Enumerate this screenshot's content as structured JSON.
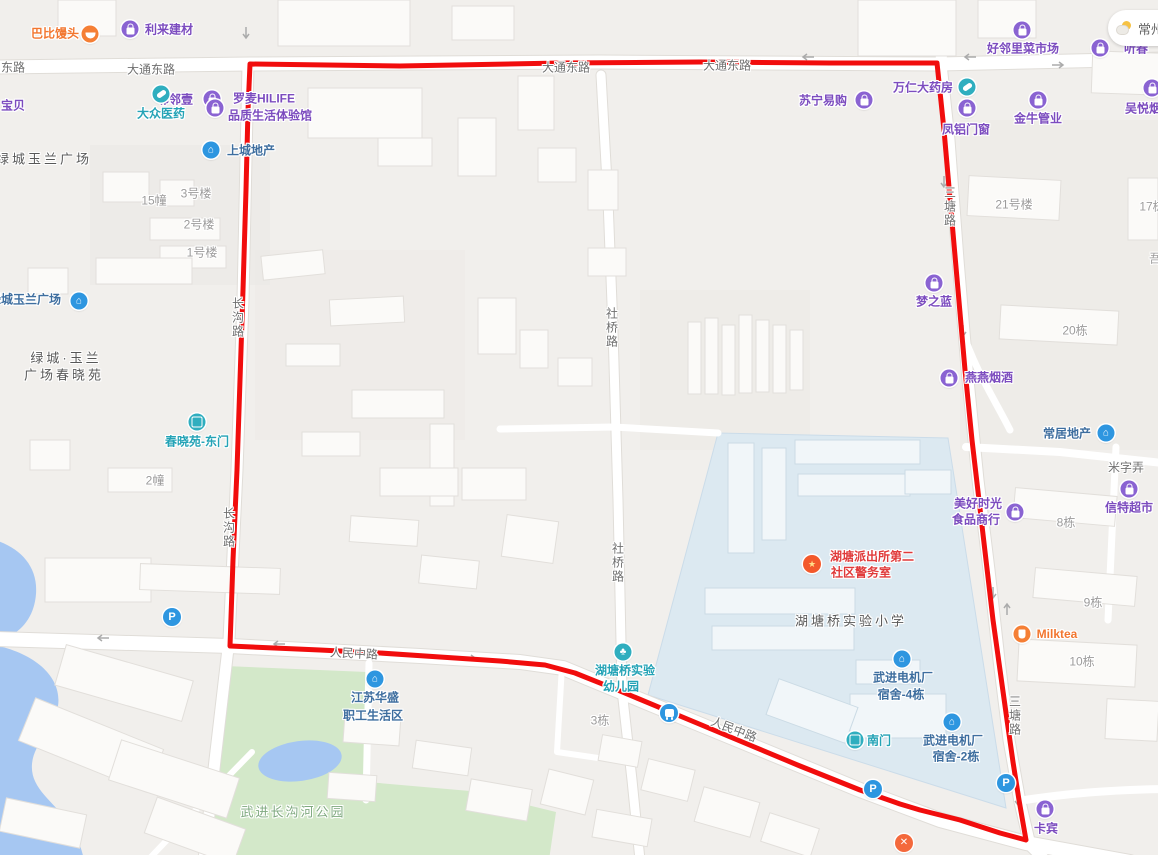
{
  "weather": {
    "city": "常州"
  },
  "colors": {
    "overlay_red": "#F10D0D",
    "land": "#F1EFEC",
    "water": "#A6C7F2",
    "park": "#D3E8C9",
    "campus": "#DCE9F1",
    "road": "#FFFFFF",
    "poi_purple": "#7C4CBF",
    "poi_teal": "#24A3B6",
    "poi_orange": "#F2762F",
    "poi_red": "#E03A3A",
    "poi_residential_blue": "#3E6E9F"
  },
  "overlay": {
    "color": "#F10D0D",
    "width": 5,
    "points": [
      [
        250,
        64
      ],
      [
        400,
        66
      ],
      [
        560,
        63
      ],
      [
        700,
        62
      ],
      [
        830,
        63
      ],
      [
        937,
        63
      ],
      [
        944,
        130
      ],
      [
        951,
        210
      ],
      [
        958,
        290
      ],
      [
        965,
        370
      ],
      [
        972,
        440
      ],
      [
        979,
        500
      ],
      [
        986,
        560
      ],
      [
        993,
        620
      ],
      [
        1000,
        670
      ],
      [
        1007,
        720
      ],
      [
        1013,
        762
      ],
      [
        1019,
        800
      ],
      [
        1026,
        840
      ],
      [
        1000,
        833
      ],
      [
        960,
        820
      ],
      [
        920,
        810
      ],
      [
        900,
        804
      ],
      [
        860,
        790
      ],
      [
        800,
        766
      ],
      [
        740,
        741
      ],
      [
        680,
        716
      ],
      [
        620,
        691
      ],
      [
        575,
        673
      ],
      [
        545,
        665
      ],
      [
        500,
        661
      ],
      [
        440,
        657
      ],
      [
        380,
        653
      ],
      [
        320,
        650
      ],
      [
        230,
        646
      ],
      [
        233,
        560
      ],
      [
        237,
        470
      ],
      [
        240,
        380
      ],
      [
        243,
        290
      ],
      [
        246,
        190
      ],
      [
        248,
        110
      ],
      [
        250,
        64
      ]
    ]
  },
  "labels": [
    {
      "id": "road-donglu",
      "t": "东路",
      "x": 13,
      "y": 67,
      "c": "road"
    },
    {
      "id": "road-datong-1",
      "t": "大通东路",
      "x": 151,
      "y": 69,
      "c": "road"
    },
    {
      "id": "road-datong-2",
      "t": "大通东路",
      "x": 566,
      "y": 67,
      "c": "road"
    },
    {
      "id": "road-datong-3",
      "t": "大通东路",
      "x": 727,
      "y": 65,
      "c": "road"
    },
    {
      "id": "road-changgou-1",
      "t": "长沟路",
      "x": 238,
      "y": 318,
      "c": "road",
      "v": true
    },
    {
      "id": "road-changgou-2",
      "t": "长沟路",
      "x": 229,
      "y": 528,
      "c": "road",
      "v": true
    },
    {
      "id": "road-sheqiao-1",
      "t": "社桥路",
      "x": 612,
      "y": 328,
      "c": "road",
      "v": true
    },
    {
      "id": "road-sheqiao-2",
      "t": "社桥路",
      "x": 618,
      "y": 563,
      "c": "road",
      "v": true
    },
    {
      "id": "road-santang-1",
      "t": "三塘路",
      "x": 950,
      "y": 207,
      "c": "road",
      "v": true
    },
    {
      "id": "road-santang-2",
      "t": "三塘路",
      "x": 1015,
      "y": 716,
      "c": "road",
      "v": true
    },
    {
      "id": "road-renmin-1",
      "t": "人民中路",
      "x": 354,
      "y": 653,
      "c": "road",
      "r": 3
    },
    {
      "id": "road-renmin-2",
      "t": "人民中路",
      "x": 734,
      "y": 729,
      "c": "road",
      "r": 21
    },
    {
      "id": "road-mizi",
      "t": "米字弄",
      "x": 1126,
      "y": 467,
      "c": "road"
    },
    {
      "id": "bldg-3haolou",
      "t": "3号楼",
      "x": 196,
      "y": 193,
      "c": "dim"
    },
    {
      "id": "bldg-15zhuang",
      "t": "15幢",
      "x": 154,
      "y": 200,
      "c": "dim"
    },
    {
      "id": "bldg-2haolou",
      "t": "2号楼",
      "x": 199,
      "y": 224,
      "c": "dim"
    },
    {
      "id": "bldg-1haolou",
      "t": "1号楼",
      "x": 202,
      "y": 252,
      "c": "dim"
    },
    {
      "id": "bldg-2zhuang",
      "t": "2幢",
      "x": 155,
      "y": 480,
      "c": "dim"
    },
    {
      "id": "bldg-3dong",
      "t": "3栋",
      "x": 600,
      "y": 720,
      "c": "dim"
    },
    {
      "id": "bldg-21haolou",
      "t": "21号楼",
      "x": 1014,
      "y": 204,
      "c": "dim"
    },
    {
      "id": "bldg-17dong",
      "t": "17栋",
      "x": 1152,
      "y": 206,
      "c": "dim"
    },
    {
      "id": "bldg-wu",
      "t": "吾",
      "x": 1155,
      "y": 258,
      "c": "dim"
    },
    {
      "id": "bldg-20dong",
      "t": "20栋",
      "x": 1075,
      "y": 330,
      "c": "dim"
    },
    {
      "id": "bldg-8dong",
      "t": "8栋",
      "x": 1066,
      "y": 522,
      "c": "dim"
    },
    {
      "id": "bldg-9dong",
      "t": "9栋",
      "x": 1093,
      "y": 602,
      "c": "dim"
    },
    {
      "id": "bldg-10dong",
      "t": "10栋",
      "x": 1082,
      "y": 661,
      "c": "dim"
    },
    {
      "id": "area-lvcheng-plaza",
      "t": "绿城玉兰广场",
      "x": 44,
      "y": 158,
      "c": "area"
    },
    {
      "id": "area-lvcheng-chunxiao-1",
      "t": "绿城·玉兰",
      "x": 66,
      "y": 357,
      "c": "area"
    },
    {
      "id": "area-lvcheng-chunxiao-2",
      "t": "广场春晓苑",
      "x": 64,
      "y": 374,
      "c": "area"
    },
    {
      "id": "area-hutangqiao-primary-school",
      "t": "湖塘桥实验小学",
      "x": 851,
      "y": 620,
      "c": "area"
    },
    {
      "id": "area-changgou-park",
      "t": "武进长沟河公园",
      "x": 293,
      "y": 811,
      "c": "green"
    },
    {
      "id": "poi-babi-mantou",
      "t": "巴比馒头",
      "x": 55,
      "y": 33,
      "c": "orange"
    },
    {
      "id": "poi-lilai-jiancai",
      "t": "利来建材",
      "x": 169,
      "y": 29,
      "c": "purple"
    },
    {
      "id": "poi-haolinli-market",
      "t": "好邻里菜市场",
      "x": 1023,
      "y": 48,
      "c": "purple"
    },
    {
      "id": "poi-linlinyi",
      "t": "邻邻壹",
      "x": 175,
      "y": 99,
      "c": "purple"
    },
    {
      "id": "poi-baobei",
      "t": "宝贝",
      "x": 13,
      "y": 105,
      "c": "purple"
    },
    {
      "id": "poi-luomai-1",
      "t": "罗麦HILIFE",
      "x": 264,
      "y": 98,
      "c": "purple"
    },
    {
      "id": "poi-luomai-2",
      "t": "品质生活体验馆",
      "x": 270,
      "y": 115,
      "c": "purple"
    },
    {
      "id": "poi-suning",
      "t": "苏宁易购",
      "x": 823,
      "y": 100,
      "c": "purple"
    },
    {
      "id": "poi-wanren-pharmacy",
      "t": "万仁大药房",
      "x": 923,
      "y": 87,
      "c": "purple"
    },
    {
      "id": "poi-fenglv",
      "t": "凤铝门窗",
      "x": 966,
      "y": 129,
      "c": "purple"
    },
    {
      "id": "poi-jinniu",
      "t": "金牛管业",
      "x": 1038,
      "y": 118,
      "c": "purple"
    },
    {
      "id": "poi-wuyue",
      "t": "吴悦烟酒",
      "x": 1149,
      "y": 108,
      "c": "purple"
    },
    {
      "id": "poi-tingchun",
      "t": "听春",
      "x": 1136,
      "y": 48,
      "c": "purple"
    },
    {
      "id": "poi-mengzhilan",
      "t": "梦之蓝",
      "x": 934,
      "y": 301,
      "c": "purple"
    },
    {
      "id": "poi-yanyan",
      "t": "燕燕烟酒",
      "x": 989,
      "y": 377,
      "c": "purple"
    },
    {
      "id": "poi-xinte-super",
      "t": "信特超市",
      "x": 1129,
      "y": 507,
      "c": "purple"
    },
    {
      "id": "poi-meihao-1",
      "t": "美好时光",
      "x": 978,
      "y": 503,
      "c": "purple"
    },
    {
      "id": "poi-meihao-2",
      "t": "食品商行",
      "x": 976,
      "y": 519,
      "c": "purple"
    },
    {
      "id": "poi-kabin",
      "t": "卡宾",
      "x": 1046,
      "y": 828,
      "c": "purple"
    },
    {
      "id": "poi-dazhong-pharmacy",
      "t": "大众医药",
      "x": 161,
      "y": 113,
      "c": "teal"
    },
    {
      "id": "poi-chunxiao-east-gate",
      "t": "春晓苑-东门",
      "x": 197,
      "y": 441,
      "c": "teal"
    },
    {
      "id": "poi-south-gate",
      "t": "南门",
      "x": 879,
      "y": 740,
      "c": "teal"
    },
    {
      "id": "poi-kindergarten-1",
      "t": "湖塘桥实验",
      "x": 625,
      "y": 670,
      "c": "teal"
    },
    {
      "id": "poi-kindergarten-2",
      "t": "幼儿园",
      "x": 621,
      "y": 686,
      "c": "teal"
    },
    {
      "id": "poi-milktea",
      "t": "Milktea",
      "x": 1057,
      "y": 634,
      "c": "orange"
    },
    {
      "id": "poi-police-1",
      "t": "湖塘派出所第二",
      "x": 872,
      "y": 556,
      "c": "red"
    },
    {
      "id": "poi-police-2",
      "t": "社区警务室",
      "x": 861,
      "y": 572,
      "c": "red"
    },
    {
      "id": "poi-shangcheng-estate",
      "t": "上城地产",
      "x": 251,
      "y": 150,
      "c": "resid"
    },
    {
      "id": "poi-lvcheng-plaza-2",
      "t": "绿城玉兰广场",
      "x": 25,
      "y": 299,
      "c": "resid"
    },
    {
      "id": "poi-changju-estate",
      "t": "常居地产",
      "x": 1067,
      "y": 433,
      "c": "resid"
    },
    {
      "id": "poi-dianji-4-1",
      "t": "武进电机厂",
      "x": 903,
      "y": 677,
      "c": "resid"
    },
    {
      "id": "poi-dianji-4-2",
      "t": "宿舍-4栋",
      "x": 901,
      "y": 694,
      "c": "resid"
    },
    {
      "id": "poi-dianji-2-1",
      "t": "武进电机厂",
      "x": 953,
      "y": 740,
      "c": "resid"
    },
    {
      "id": "poi-dianji-2-2",
      "t": "宿舍-2栋",
      "x": 956,
      "y": 756,
      "c": "resid"
    },
    {
      "id": "poi-jiangsu-huasheng-1",
      "t": "江苏华盛",
      "x": 375,
      "y": 697,
      "c": "resid"
    },
    {
      "id": "poi-jiangsu-huasheng-2",
      "t": "职工生活区",
      "x": 373,
      "y": 715,
      "c": "resid"
    }
  ],
  "icons": [
    {
      "id": "babi-mantou",
      "g": "bun",
      "x": 90,
      "y": 34,
      "c": "orange"
    },
    {
      "id": "lilai-jiancai",
      "g": "bag",
      "x": 130,
      "y": 29,
      "c": "purple"
    },
    {
      "id": "haolinli-market",
      "g": "bag",
      "x": 1022,
      "y": 30,
      "c": "purple"
    },
    {
      "id": "linlinyi",
      "g": "bag",
      "x": 212,
      "y": 99,
      "c": "purple"
    },
    {
      "id": "dazhong-pharmacy",
      "g": "pill",
      "x": 161,
      "y": 94,
      "c": "teal"
    },
    {
      "id": "luomai",
      "g": "bag",
      "x": 215,
      "y": 108,
      "c": "purple"
    },
    {
      "id": "shangcheng-estate",
      "g": "house",
      "x": 211,
      "y": 150,
      "c": "blue"
    },
    {
      "id": "suning",
      "g": "bag",
      "x": 864,
      "y": 100,
      "c": "purple"
    },
    {
      "id": "wanren-pharmacy",
      "g": "pill",
      "x": 967,
      "y": 87,
      "c": "teal"
    },
    {
      "id": "fenglv",
      "g": "bag",
      "x": 967,
      "y": 108,
      "c": "purple"
    },
    {
      "id": "jinniu",
      "g": "bag",
      "x": 1038,
      "y": 100,
      "c": "purple"
    },
    {
      "id": "wuyue",
      "g": "bag",
      "x": 1152,
      "y": 88,
      "c": "purple"
    },
    {
      "id": "tingchun",
      "g": "bag",
      "x": 1100,
      "y": 48,
      "c": "purple"
    },
    {
      "id": "mengzhilan",
      "g": "bag",
      "x": 934,
      "y": 283,
      "c": "purple"
    },
    {
      "id": "yanyan",
      "g": "bag",
      "x": 949,
      "y": 378,
      "c": "purple"
    },
    {
      "id": "changju-estate",
      "g": "house",
      "x": 1106,
      "y": 433,
      "c": "blue"
    },
    {
      "id": "xinte-super",
      "g": "bag",
      "x": 1129,
      "y": 489,
      "c": "purple"
    },
    {
      "id": "meihao",
      "g": "bag",
      "x": 1015,
      "y": 512,
      "c": "purple"
    },
    {
      "id": "milktea",
      "g": "cup",
      "x": 1022,
      "y": 634,
      "c": "orange"
    },
    {
      "id": "kabin",
      "g": "bag",
      "x": 1045,
      "y": 809,
      "c": "purple"
    },
    {
      "id": "chunxiao-east-gate",
      "g": "door",
      "x": 197,
      "y": 422,
      "c": "teal"
    },
    {
      "id": "police-badge",
      "g": "badge",
      "x": 812,
      "y": 564,
      "c": "police"
    },
    {
      "id": "dianji-dorm-4",
      "g": "house",
      "x": 902,
      "y": 659,
      "c": "blue"
    },
    {
      "id": "dianji-dorm-2",
      "g": "house",
      "x": 952,
      "y": 722,
      "c": "blue"
    },
    {
      "id": "south-gate",
      "g": "door",
      "x": 855,
      "y": 740,
      "c": "teal"
    },
    {
      "id": "kindergarten",
      "g": "tree",
      "x": 623,
      "y": 652,
      "c": "teal"
    },
    {
      "id": "jiangsu-huasheng",
      "g": "house",
      "x": 375,
      "y": 679,
      "c": "blue"
    },
    {
      "id": "lvcheng-plaza",
      "g": "house",
      "x": 79,
      "y": 301,
      "c": "blue"
    },
    {
      "id": "parking-1",
      "g": "P",
      "x": 172,
      "y": 617,
      "c": "blue"
    },
    {
      "id": "parking-2",
      "g": "P",
      "x": 873,
      "y": 789,
      "c": "blue"
    },
    {
      "id": "parking-3",
      "g": "P",
      "x": 1006,
      "y": 783,
      "c": "blue"
    },
    {
      "id": "bus-stop",
      "g": "bus",
      "x": 669,
      "y": 713,
      "c": "blue"
    },
    {
      "id": "restaurant",
      "g": "x",
      "x": 904,
      "y": 843,
      "c": "food"
    }
  ]
}
